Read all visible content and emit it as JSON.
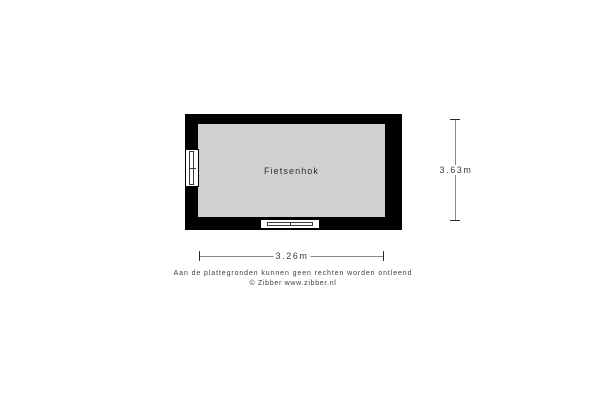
{
  "floorplan": {
    "room_label": "Fietsenhok",
    "dimensions": {
      "width_label": "3.26m",
      "height_label": "3.63m"
    },
    "features": {
      "window_left": "window",
      "window_bottom": "window"
    }
  },
  "footer": {
    "disclaimer": "Aan de plattegronden kunnen geen rechten worden ontleend",
    "copyright": "© Zibber www.zibber.nl"
  },
  "colors": {
    "wall": "#000000",
    "floor": "#d0d0d0",
    "background": "#ffffff",
    "dim_line": "#8a8a8a",
    "text": "#3c3c3c"
  }
}
